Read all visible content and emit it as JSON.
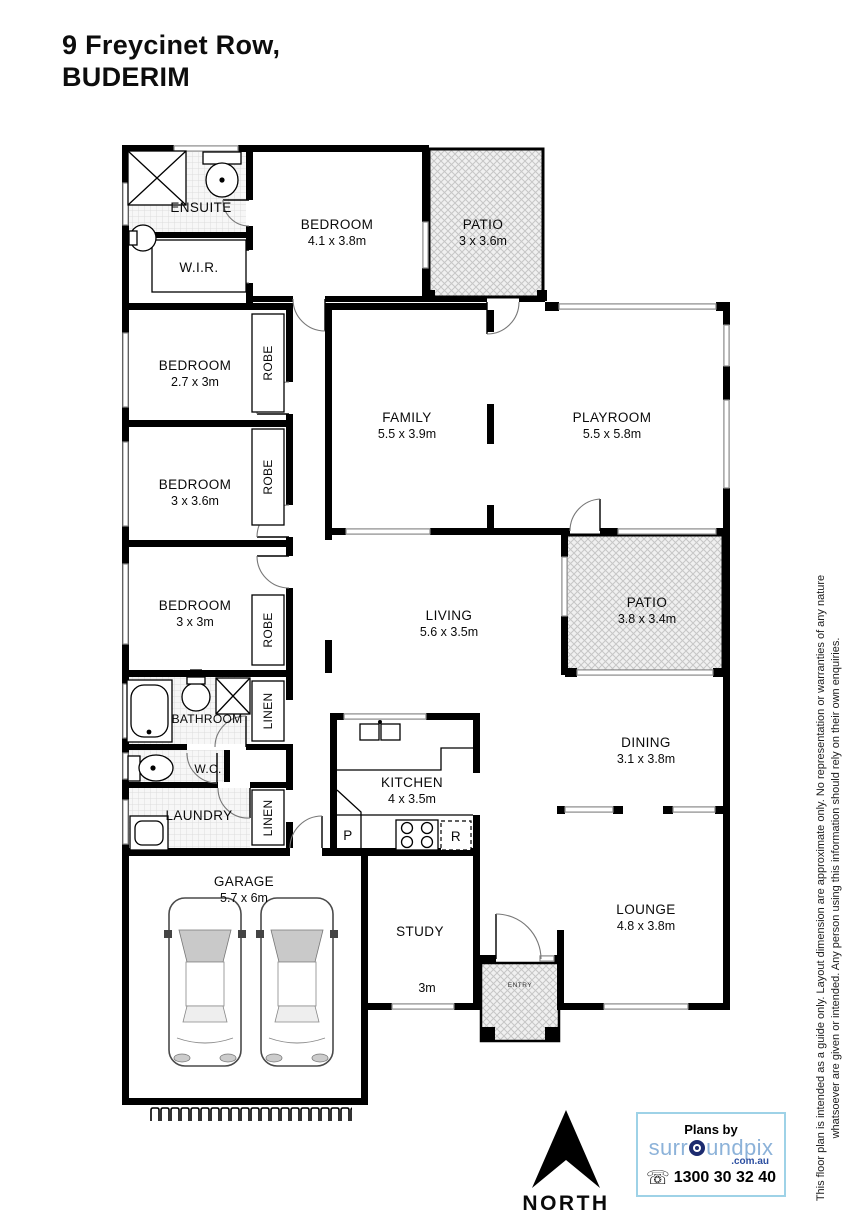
{
  "header": {
    "address_line1": "9 Freycinet Row,",
    "address_line2": "BUDERIM"
  },
  "rooms": {
    "ensuite": {
      "name": "ENSUITE"
    },
    "wir": {
      "name": "W.I.R."
    },
    "bedroom1": {
      "name": "BEDROOM",
      "dims": "4.1 x 3.8m"
    },
    "patio1": {
      "name": "PATIO",
      "dims": "3 x 3.6m"
    },
    "bedroom2": {
      "name": "BEDROOM",
      "dims": "2.7 x 3m"
    },
    "family": {
      "name": "FAMILY",
      "dims": "5.5 x 3.9m"
    },
    "playroom": {
      "name": "PLAYROOM",
      "dims": "5.5 x 5.8m"
    },
    "bedroom3": {
      "name": "BEDROOM",
      "dims": "3 x 3.6m"
    },
    "bedroom4": {
      "name": "BEDROOM",
      "dims": "3 x 3m"
    },
    "living": {
      "name": "LIVING",
      "dims": "5.6 x 3.5m"
    },
    "patio2": {
      "name": "PATIO",
      "dims": "3.8 x 3.4m"
    },
    "bathroom": {
      "name": "BATHROOM"
    },
    "wc": {
      "name": "W.C."
    },
    "laundry": {
      "name": "LAUNDRY"
    },
    "kitchen": {
      "name": "KITCHEN",
      "dims": "4 x 3.5m"
    },
    "dining": {
      "name": "DINING",
      "dims": "3.1 x 3.8m"
    },
    "garage": {
      "name": "GARAGE",
      "dims": "5.7 x 6m"
    },
    "study": {
      "name": "STUDY",
      "window_dim": "3m"
    },
    "lounge": {
      "name": "LOUNGE",
      "dims": "4.8 x 3.8m"
    },
    "entry": {
      "name": "ENTRY"
    }
  },
  "closets": {
    "robe": "ROBE",
    "linen": "LINEN"
  },
  "kitchen_items": {
    "pantry": "P",
    "fridge": "R"
  },
  "compass": {
    "label": "NORTH"
  },
  "branding": {
    "plans_by": "Plans by",
    "brand_prefix": "surr",
    "brand_suffix": "undpix",
    "domain": ".com.au",
    "phone": "1300 30 32 40",
    "brand_color": "#8cb2d9",
    "domain_color": "#2b4ea0",
    "box_border_color": "#9ed2e7"
  },
  "disclaimer": {
    "line1": "This floor plan is intended as a guide only. Layout dimension are approximate only. No representation or warranties of any nature",
    "line2": "whatsoever are given or intended. Any person using this information should rely on their own enquiries."
  }
}
